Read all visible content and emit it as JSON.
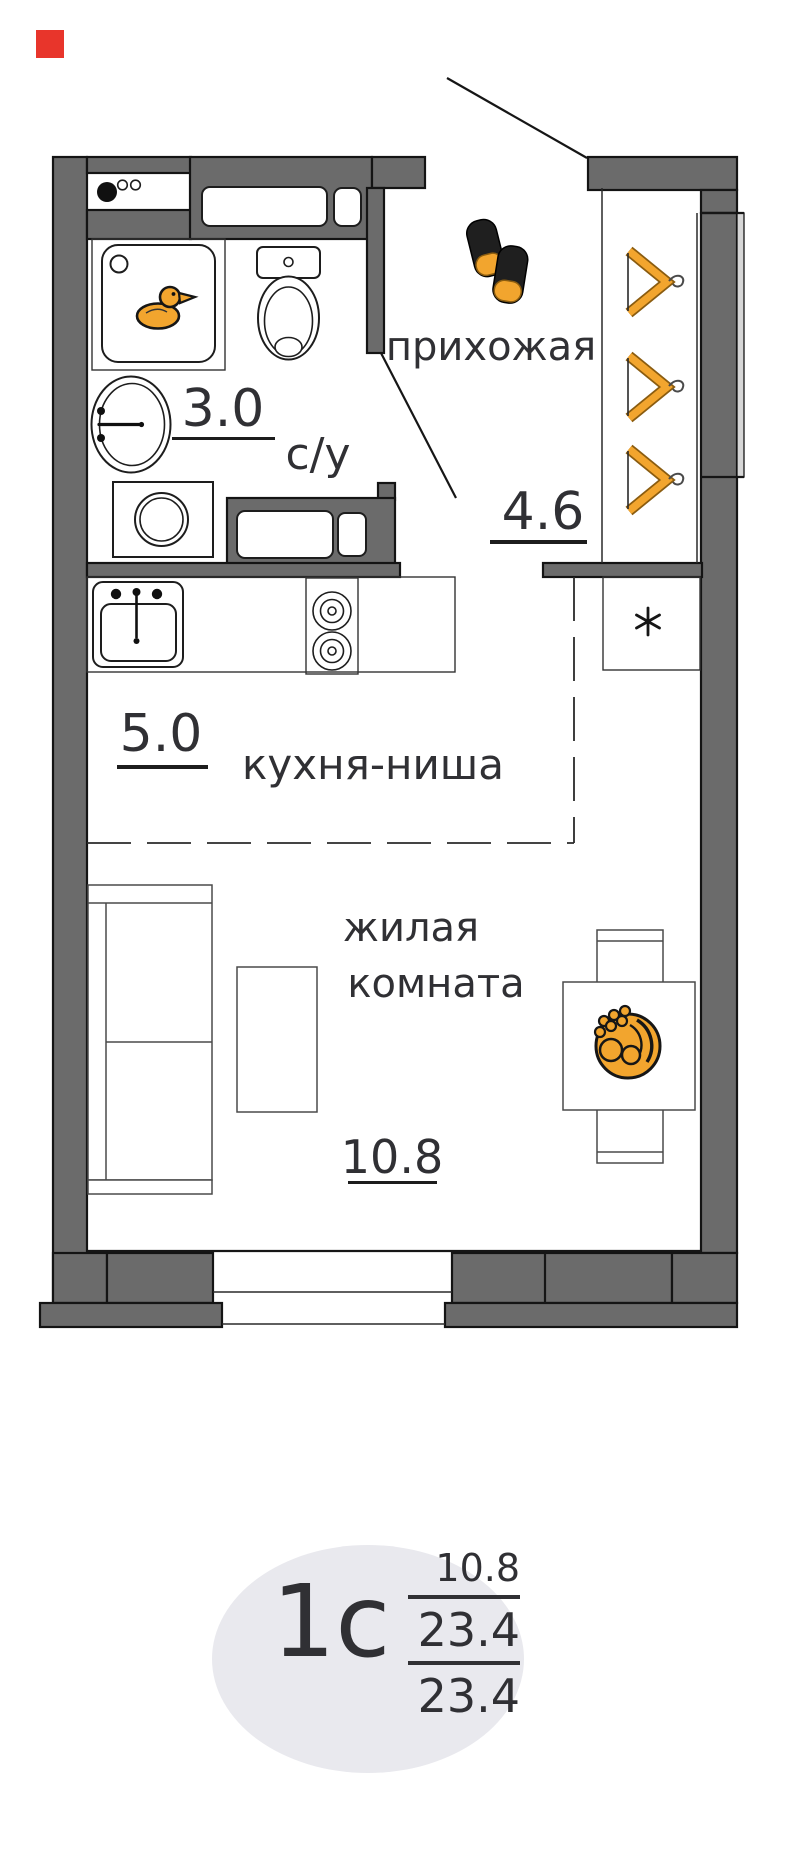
{
  "rooms": {
    "bathroom": {
      "label": "с/у",
      "area": "3.0"
    },
    "hallway": {
      "label": "прихожая",
      "area": "4.6"
    },
    "kitchen": {
      "label": "кухня-ниша",
      "area": "5.0"
    },
    "living": {
      "label_line1": "жилая",
      "label_line2": "комната",
      "area": "10.8"
    }
  },
  "badge": {
    "unit_type": "1с",
    "living_area": "10.8",
    "area_excl_balcony": "23.4",
    "total_area": "23.4"
  },
  "symbols": {
    "closet_mark": "*"
  },
  "icons": {
    "bath_icon": "rubber-duck-icon",
    "hallway_icons": [
      "slippers-icon",
      "hanger-icon",
      "hanger-icon",
      "hanger-icon"
    ],
    "table_icon": "fruit-bowl-icon",
    "closet_icon": "closet-star-icon"
  },
  "colors": {
    "wall": "#6b6b6b",
    "outline": "#141414",
    "accent_orange": "#f2a52e",
    "marker_red": "#e8352b",
    "badge_bg": "#e9e9ee",
    "text": "#303034"
  }
}
